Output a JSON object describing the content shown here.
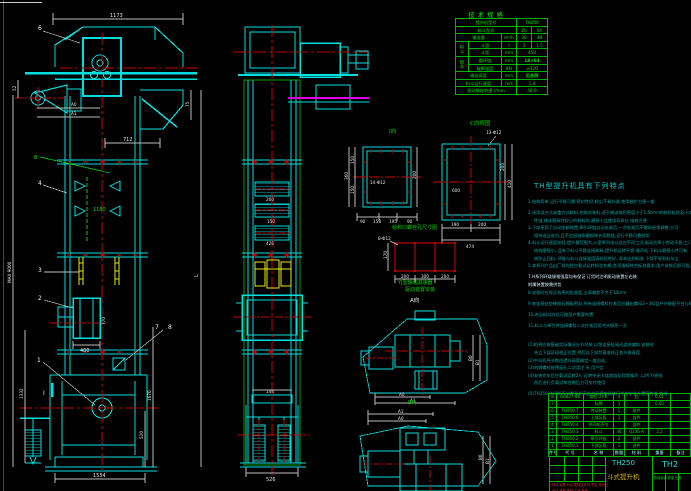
{
  "front_view": {
    "dims": {
      "top": "1173",
      "mid": "712",
      "shaft_offset": "52",
      "spout_h": "75",
      "a0": "A0",
      "a1": "A1",
      "pitch_green": "1180",
      "b_mark": "B",
      "inlet_w": "480",
      "inlet_h": "770",
      "left_total": "1332",
      "max_mark": "MAX 9000",
      "height_mark": "L",
      "boot_h": "1670",
      "boot_inner": "520",
      "base": "1554",
      "section": "I"
    },
    "balloons": {
      "b6": "6",
      "b4": "4",
      "b3": "3",
      "b2": "2",
      "b1": "1",
      "b7": "7",
      "b8": "8"
    }
  },
  "side_view": {
    "dims": {
      "d1": "260",
      "d2": "150",
      "d3": "426",
      "plate": "144",
      "base": "526"
    }
  },
  "flange_i": {
    "label": "I向",
    "holes": "14-Φ12",
    "dims": {
      "l1": "150",
      "l2": "150",
      "ltot": "360",
      "r1": "200",
      "b1": "90",
      "b2": "158",
      "b3": "195",
      "b4": "90"
    }
  },
  "flange_c": {
    "label": "C向视图",
    "holes": "13-Φ12",
    "inner": "600",
    "dims": {
      "r1": "200",
      "r2": "410",
      "b1": "190",
      "b2": "200",
      "total": "474"
    }
  },
  "bolt_grid": {
    "title": "给料口螺栓孔尺寸图",
    "holes": "8-Φ12",
    "left": "170",
    "b1": "200",
    "b2": "300",
    "b3": "200"
  },
  "drive_top": {
    "title1": "YJ型轴装减速器",
    "title2": "驱动装置安装",
    "view_label": "A向",
    "a0": "A0",
    "a1": "A1",
    "b0": "B0",
    "b1": "B1"
  },
  "drive_bottom": {
    "view_label": "B向",
    "a1": "A1",
    "a0": "A0",
    "b0": "B0",
    "b1": "B1"
  },
  "tech": {
    "title": "技术规格",
    "r1_label": "提升机型号",
    "r1_value": "TH250",
    "r2_label": "料斗型式",
    "r2_v1": "Zh",
    "r2_v2": "Sh",
    "r3_label": "输送量",
    "r3_unit": "m³/h",
    "r3_v1": "30",
    "r3_v2": "48",
    "g1": "料斗",
    "r4_label": "斗容",
    "r4_unit": "l",
    "r4_v1": "3",
    "r4_v2": "1.5",
    "r5_label": "斗距",
    "r5_unit": "mm",
    "r5_value": "450",
    "g2": "链条",
    "r6_label": "圆环链",
    "r6_unit": "mm",
    "r6_value": "18×64",
    "r7_label": "破断强度",
    "r7_unit": "KN",
    "r7_value": "≥320",
    "r8_label": "输送高度",
    "r8_unit": "mm",
    "r8_value": "见合同",
    "r9_label": "料斗运行速度",
    "r9_unit": "m/s",
    "r9_value": "1.4",
    "r10_label": "驱动链轮转速 r/min",
    "r10_value": "48.0"
  },
  "notes": {
    "heading": "TH型提升机具有下列特点",
    "lines": [
      "1.结构简单,运行平稳可靠,密封性好,粉尘不易外逸,使用维护方便一般",
      "2.采用混合式或重力式卸料,挖取式装料,适于输送堆积密度小于1.5t/m³的粉状粒状及小块状物料,对一般物料适应",
      "性强,输送磨琢性较小的物料时,磨损小且使用寿命长 维修方便",
      "3.下部采用了自动张紧装置,牵引环链自动张紧后,一次张紧后不需再经常调整,方可",
      "保持适当张力,且不会因链条磨损伸长而脱链,运行平稳可靠耐用",
      "4.料斗运行速度较低,提升量范围大,斗宽系列化以适应不同工况,驱动功率小传动平稳,工门链轮采用可换齿圈",
      "结构磨损小, 且有下料斗平稳连接卸料,提升机运转平稳 噪声低 下料斗磨损小并可有",
      "效防止回料, 环链与料斗连接强度高抗拉性好, 寿命达到标准 下部不易积料灰尘",
      "5.本系列产品出厂前均经空载试运转检验合格,各项指标符合标准要求,用户安装后即可投入使用,性能可靠,运转",
      "7.H系列环链规格强度均有保证      订货时注明驱动装置左右装",
      "附属装置按需供货",
      "8.安装时应保证机壳的铅垂度,全高偏差不大于10mm",
      "9.各连接处垫橡胶石棉板密封,所有连接螺栓拧紧后应露出螺母2~3扣且户外装配平台与标准备件机构连接正常",
      "10.进出料口方位可按用户需要布置",
      "11.料斗与牵引件连接螺栓二次拧紧后用冲头铆死一次",
      "(1)机壳应按基础实际情况分节吊装,以免连接处晃动造成偏斜 安装时",
      "先立下部区段校正位置 然后以下部为基准校正各节垂直度.",
      "(2)中间机壳节数由提升高度确定一般自选,",
      "(3)地脚螺栓按预留孔二次浇注 另.用户定",
      "(4)安装完毕后空载试运转2h, 运转中无卡链跳链及异常噪声 ,以M.Y/原则,",
      "然后进行负载试车合格后方可交付使用",
      "(5)TH250 中间机壳节数及总高由合同规定具体尺寸按安装布置图为准 为准."
    ]
  },
  "bom": {
    "header": {
      "no": "件号",
      "code": "代 号",
      "name": "名 称",
      "qty": "数量",
      "mat": "材 料",
      "wt": "重量",
      "note": "备注"
    },
    "rows": [
      {
        "no": "8",
        "code": "GB827-86",
        "name": "铆钉 2×6",
        "qty": "4",
        "mat": "铝",
        "wt": "0.01",
        "note": ""
      },
      {
        "no": "7",
        "code": "",
        "name": "标牌",
        "qty": "1",
        "mat": "",
        "wt": "0.05",
        "note": ""
      },
      {
        "no": "6",
        "code": "TH250.7",
        "name": "传动装置",
        "qty": "1",
        "mat": "组件",
        "wt": "",
        "note": ""
      },
      {
        "no": "5",
        "code": "TH250.6",
        "name": "上部区段",
        "qty": "1",
        "mat": "部件",
        "wt": "",
        "note": ""
      },
      {
        "no": "4",
        "code": "TH250.4",
        "name": "中间机壳节",
        "qty": "",
        "mat": "部件",
        "wt": "",
        "note": ""
      },
      {
        "no": "3",
        "code": "TH250.3",
        "name": "料斗",
        "qty": "46",
        "mat": "Q235-A",
        "wt": "2.2",
        "note": ""
      },
      {
        "no": "2",
        "code": "TH250.2",
        "name": "牵引环链",
        "qty": "2",
        "mat": "部件",
        "wt": "",
        "note": ""
      },
      {
        "no": "1",
        "code": "TH250.1",
        "name": "下部区段",
        "qty": "1",
        "mat": "部件",
        "wt": "",
        "note": ""
      }
    ]
  },
  "title_block": {
    "model": "TH250",
    "name": "斗式提升机",
    "dwg_no": "TH2",
    "sig_row1": "标记 处数 分区 更改文件号 签名 年月日",
    "sig_row2": "设计  校核  审核  工艺  批准",
    "right_small": "阶段标记  质量  比例"
  }
}
